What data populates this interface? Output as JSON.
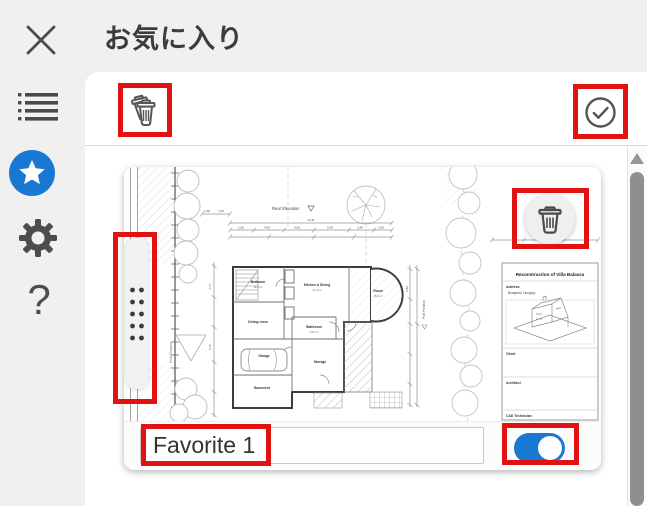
{
  "header": {
    "title": "お気に入り"
  },
  "sidebar": {
    "icons": [
      "close-icon",
      "list-icon",
      "star-icon",
      "gear-icon",
      "question-mark-icon"
    ],
    "question_mark": "?",
    "active_item": "favorites"
  },
  "toolbar": {
    "icons": [
      "trash-multiple-icon",
      "check-circle-icon"
    ]
  },
  "favorite_card": {
    "name": "Favorite 1",
    "toggle_state": "on",
    "overlay_icons": [
      "drag-handle-dots",
      "trash-icon"
    ]
  },
  "drawing": {
    "title_block": {
      "title": "Reconstruction of Villa Balassa",
      "address_label": "Address",
      "address_value": "Budapest, Hungary",
      "client_label": "Client",
      "architect_label": "Architect",
      "cad_label": "CAD Technician"
    },
    "annotations": {
      "rear_elevation": "Rear Elevation",
      "west_elevation": "West Elevation",
      "post_position": "Post Position"
    },
    "rooms": [
      "Bedroom",
      "Kitchen & Dining",
      "Room",
      "Dining room",
      "Bathroom",
      "Garage",
      "Storage",
      "Basement"
    ],
    "areas": [
      "14,0 m²",
      "21,4 m²",
      "15,6 m²",
      "4,54 m²"
    ],
    "dims": [
      "1,38",
      "7,02",
      "14,11",
      "1,50",
      "4,50",
      "3,00",
      "5,00",
      "2,40",
      "1,50",
      "3,74",
      "5,11",
      "2,89",
      "1,4"
    ]
  },
  "annotation_boxes": {
    "count": 6,
    "color": "#e11212"
  },
  "colors": {
    "accent_blue": "#1878d2",
    "annotation_red": "#e11212",
    "panel_bg": "#ffffff",
    "chrome_bg": "#f0f0f0"
  }
}
